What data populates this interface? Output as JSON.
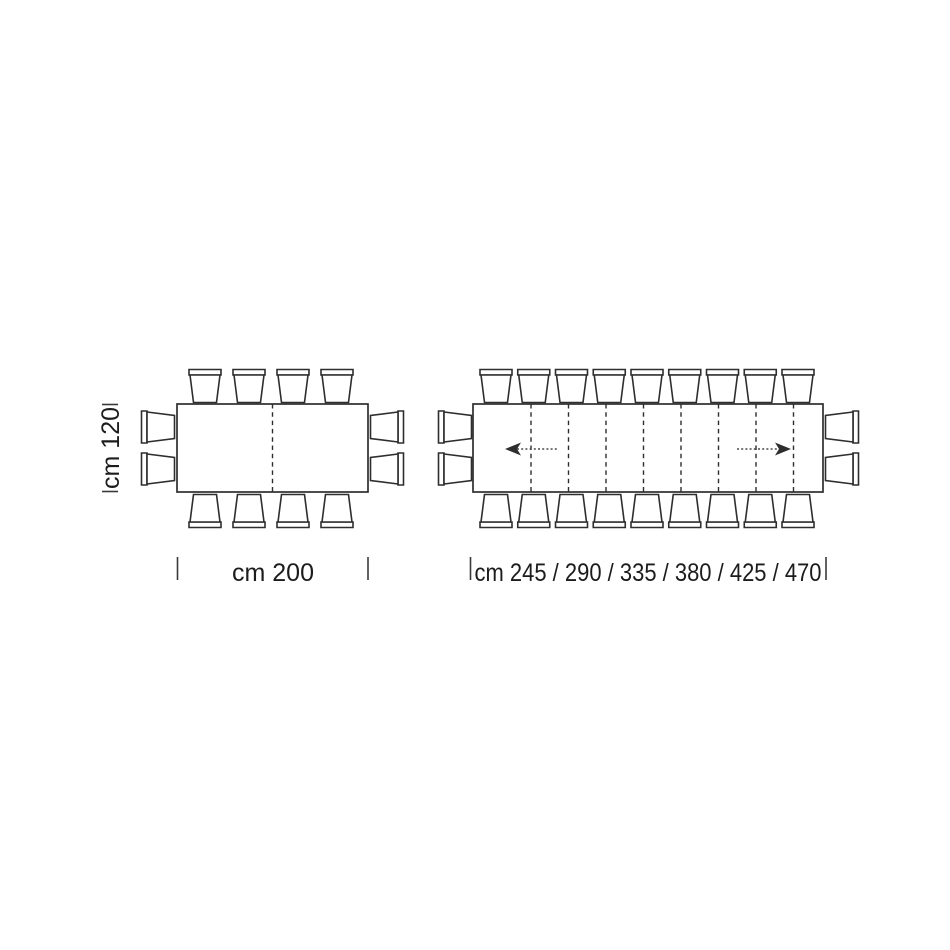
{
  "figures": {
    "fixed_table": {
      "depth_label": "cm 120",
      "length_label": "cm 200",
      "chairs": {
        "top": 4,
        "bottom": 4,
        "left": 2,
        "right": 2
      }
    },
    "extending_table": {
      "lengths_label": "cm 245 / 290 / 335 / 380 / 425 / 470",
      "extension_lengths_cm": [
        245,
        290,
        335,
        380,
        425,
        470
      ],
      "chairs": {
        "top": 9,
        "bottom": 9,
        "left": 2,
        "right": 2
      },
      "leaf_seam_lines": 8,
      "extension_arrows": [
        "left",
        "right"
      ]
    }
  },
  "colors": {
    "line": "#2e2e2e",
    "text": "#1c1c1c",
    "background": "#ffffff"
  }
}
